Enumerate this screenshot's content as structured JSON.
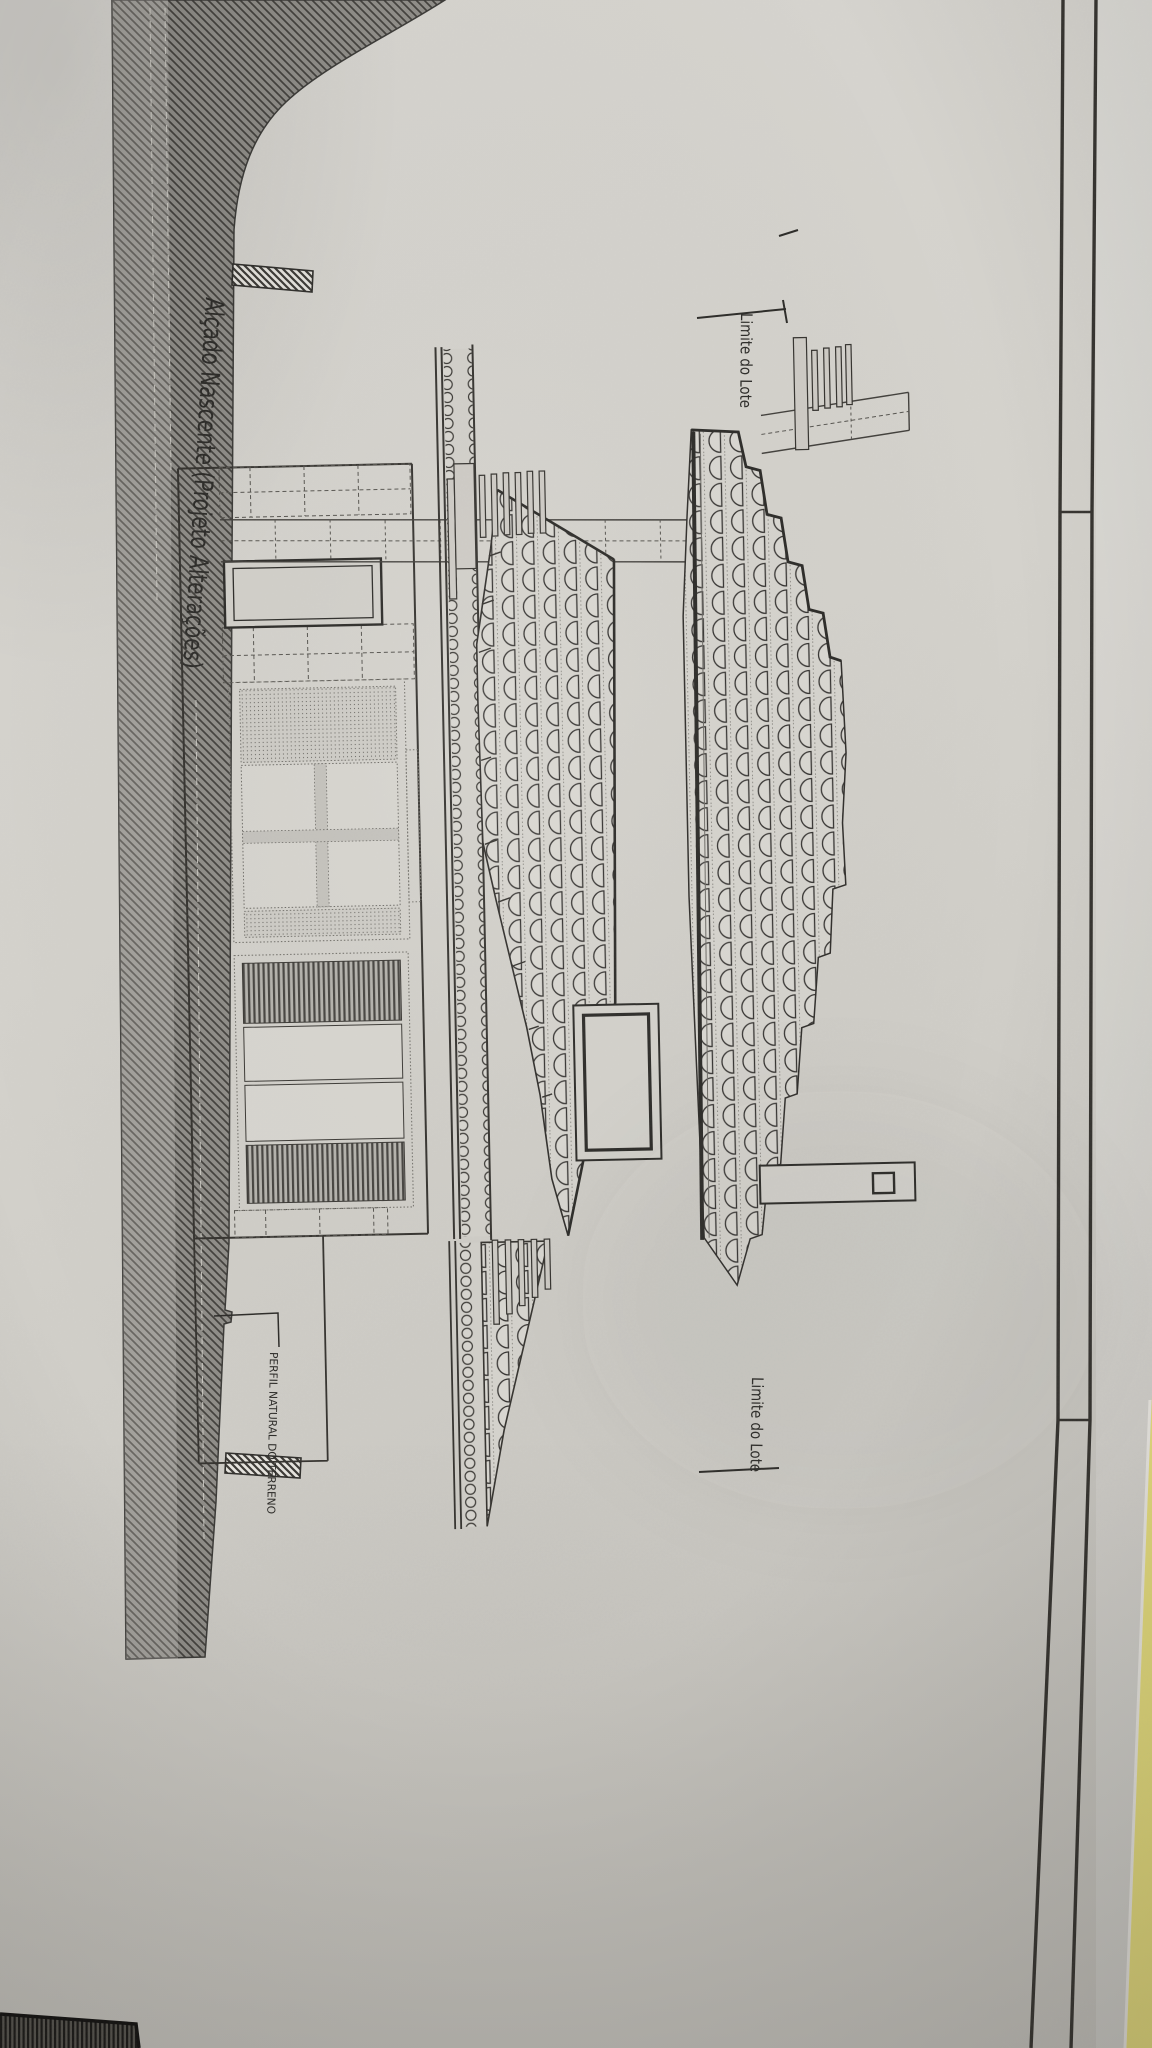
{
  "document": {
    "title": "Alçado Nascente (Projeto Alterações)",
    "label_lot_top": "Limite do Lote",
    "label_lot_bottom": "Limite do Lote",
    "label_terrain": "PERFIL NATURAL DO TERRENO"
  },
  "colors": {
    "paper": "#d5d3cd",
    "paper_light": "#dcdad5",
    "ink": "#2c2b28",
    "hatch_fill": "#8f8d88",
    "hatch_line": "#42403c",
    "tile_fill": "#d7d5cf",
    "desk_yellow": "#e7de7d",
    "desk_yellow_deep": "#d3c654",
    "dark_strip": "#22211f"
  }
}
